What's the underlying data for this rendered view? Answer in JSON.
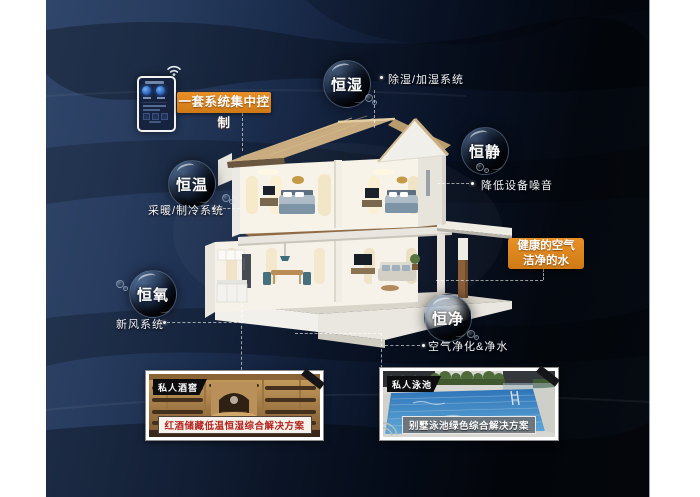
{
  "bubbles": [
    {
      "label": "恒湿",
      "desc": "除湿/加湿系统"
    },
    {
      "label": "恒静",
      "desc": "降低设备噪音"
    },
    {
      "label": "恒温",
      "desc": "采暖/制冷系统"
    },
    {
      "label": "恒氧",
      "desc": "新风系统"
    },
    {
      "label": "恒净",
      "desc": "空气净化&净水"
    }
  ],
  "control_panel": {
    "label": "一套系统集中控制"
  },
  "highlight": {
    "line1": "健康的空气",
    "line2": "洁净的水"
  },
  "photos": {
    "wine": {
      "tag": "私人酒窖",
      "caption": "红酒储藏低温恒湿综合解决方案"
    },
    "pool": {
      "tag": "私人泳池",
      "caption": "别墅泳池绿色综合解决方案"
    }
  },
  "colors": {
    "accent_orange": "#DD8520",
    "background_navy": "#2C4164",
    "background_black": "#05080F",
    "roof_tan": "#C9AD80",
    "pool_blue": "#3579BC",
    "wine_caption_red": "#B3241F",
    "label_text": "#F2F4F7"
  }
}
